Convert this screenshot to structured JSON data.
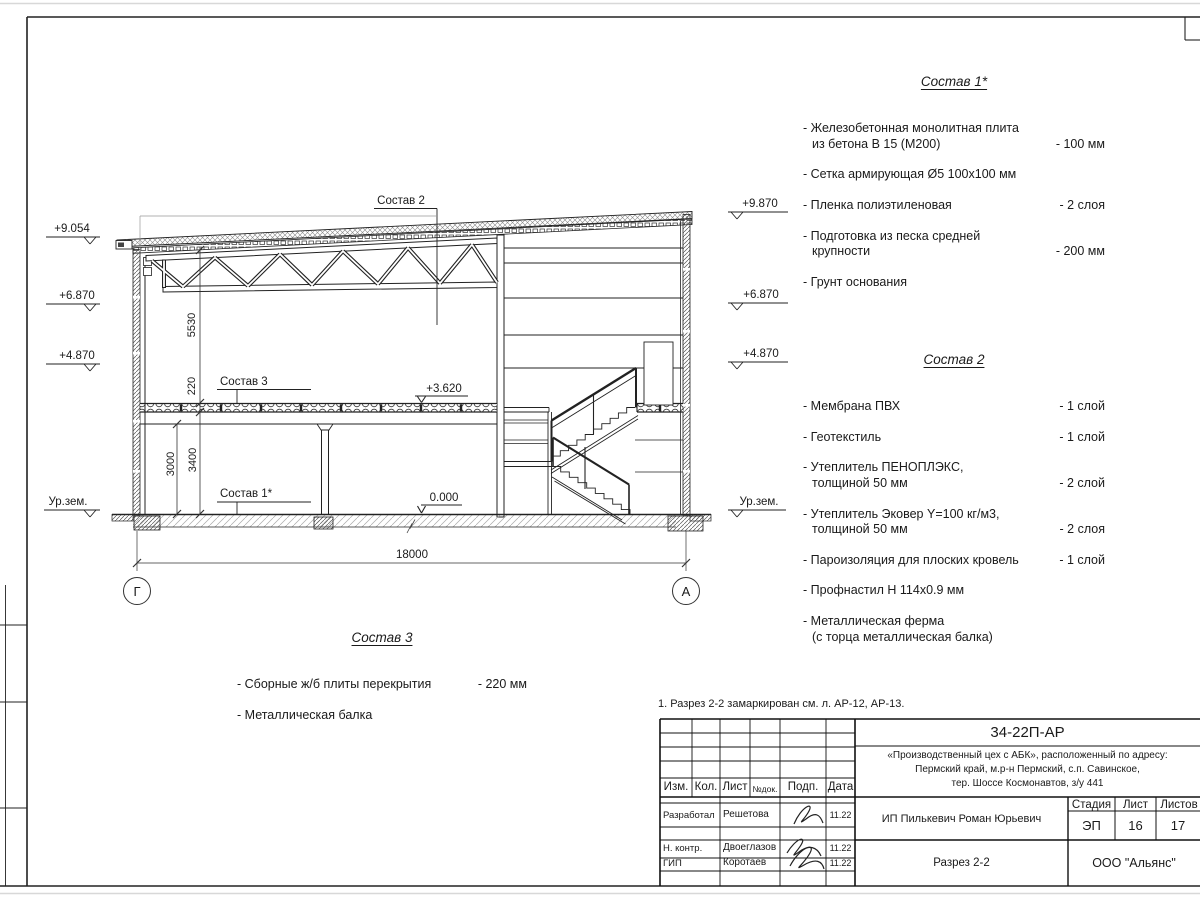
{
  "note": "1. Разрез 2-2 замаркирован см. л. АР-12, АР-13.",
  "section": {
    "elevations_left": {
      "e1": "+9.054",
      "e2": "+6.870",
      "e3": "+4.870",
      "e4": "Ур.зем."
    },
    "elevations_right": {
      "e1": "+9.870",
      "e2": "+6.870",
      "e3": "+4.870",
      "e4": "Ур.зем."
    },
    "levels": {
      "slab": "+3.620",
      "zero": "0.000"
    },
    "dims": {
      "d5530": "5530",
      "d220": "220",
      "d3000": "3000",
      "d3400": "3400",
      "d18000": "18000"
    },
    "axes": {
      "left": "Г",
      "right": "А"
    },
    "callouts": {
      "c2": "Состав 2",
      "c3": "Состав 3",
      "c1": "Состав 1*"
    }
  },
  "compositions": [
    {
      "title": "Состав 1*",
      "items": [
        {
          "text": "- Железобетонная  монолитная плита\nиз бетона В 15 (М200)",
          "value": "- 100 мм"
        },
        {
          "text": "- Сетка армирующая Ø5 100х100 мм",
          "value": ""
        },
        {
          "text": "- Пленка полиэтиленовая",
          "value": "-  2 слоя"
        },
        {
          "text": "- Подготовка из песка средней\nкрупности",
          "value": "- 200 мм"
        },
        {
          "text": "- Грунт основания",
          "value": ""
        }
      ]
    },
    {
      "title": "Состав 2",
      "items": [
        {
          "text": "- Мембрана ПВХ",
          "value": "- 1 слой"
        },
        {
          "text": "- Геотекстиль",
          "value": "- 1 слой"
        },
        {
          "text": "- Утеплитель ПЕНОПЛЭКС,\nтолщиной 50 мм",
          "value": "- 2 слой"
        },
        {
          "text": "- Утеплитель Эковер Y=100 кг/м3,\nтолщиной 50 мм",
          "value": "- 2 слоя"
        },
        {
          "text": "- Пароизоляция для плоских кровель",
          "value": "- 1 слой"
        },
        {
          "text": "- Профнастил Н 114х0.9 мм",
          "value": ""
        },
        {
          "text": "- Металлическая ферма\n(с торца металлическая балка)",
          "value": ""
        }
      ]
    },
    {
      "title": "Состав 3",
      "items": [
        {
          "text": "- Сборные ж/б  плиты перекрытия",
          "value": "- 220 мм"
        },
        {
          "text": "- Металлическая балка",
          "value": ""
        }
      ]
    }
  ],
  "titleblock": {
    "doc_code": "34-22П-АР",
    "project": "«Производственный цех с АБК», расположенный по адресу:\nПермский край, м.р-н Пермский, с.п. Савинское,\nтер. Шоссе Космонавтов, з/у 441",
    "client": "ИП Пилькевич Роман Юрьевич",
    "sheet_title": "Разрез 2-2",
    "company": "ООО \"Альянс\"",
    "header_cols": [
      "Изм.",
      "Кол.",
      "Лист",
      "№док.",
      "Подп.",
      "Дата"
    ],
    "stage_label": "Стадия",
    "sheet_label": "Лист",
    "sheets_label": "Листов",
    "stage": "ЭП",
    "sheet_no": "16",
    "sheets_total": "17",
    "rows": [
      {
        "role": "Разработал",
        "name": "Решетова",
        "date": "11.22"
      },
      {
        "role": "Н. контр.",
        "name": "Двоеглазов",
        "date": "11.22"
      },
      {
        "role": "ГИП",
        "name": "Коротаев",
        "date": "11.22"
      }
    ]
  }
}
